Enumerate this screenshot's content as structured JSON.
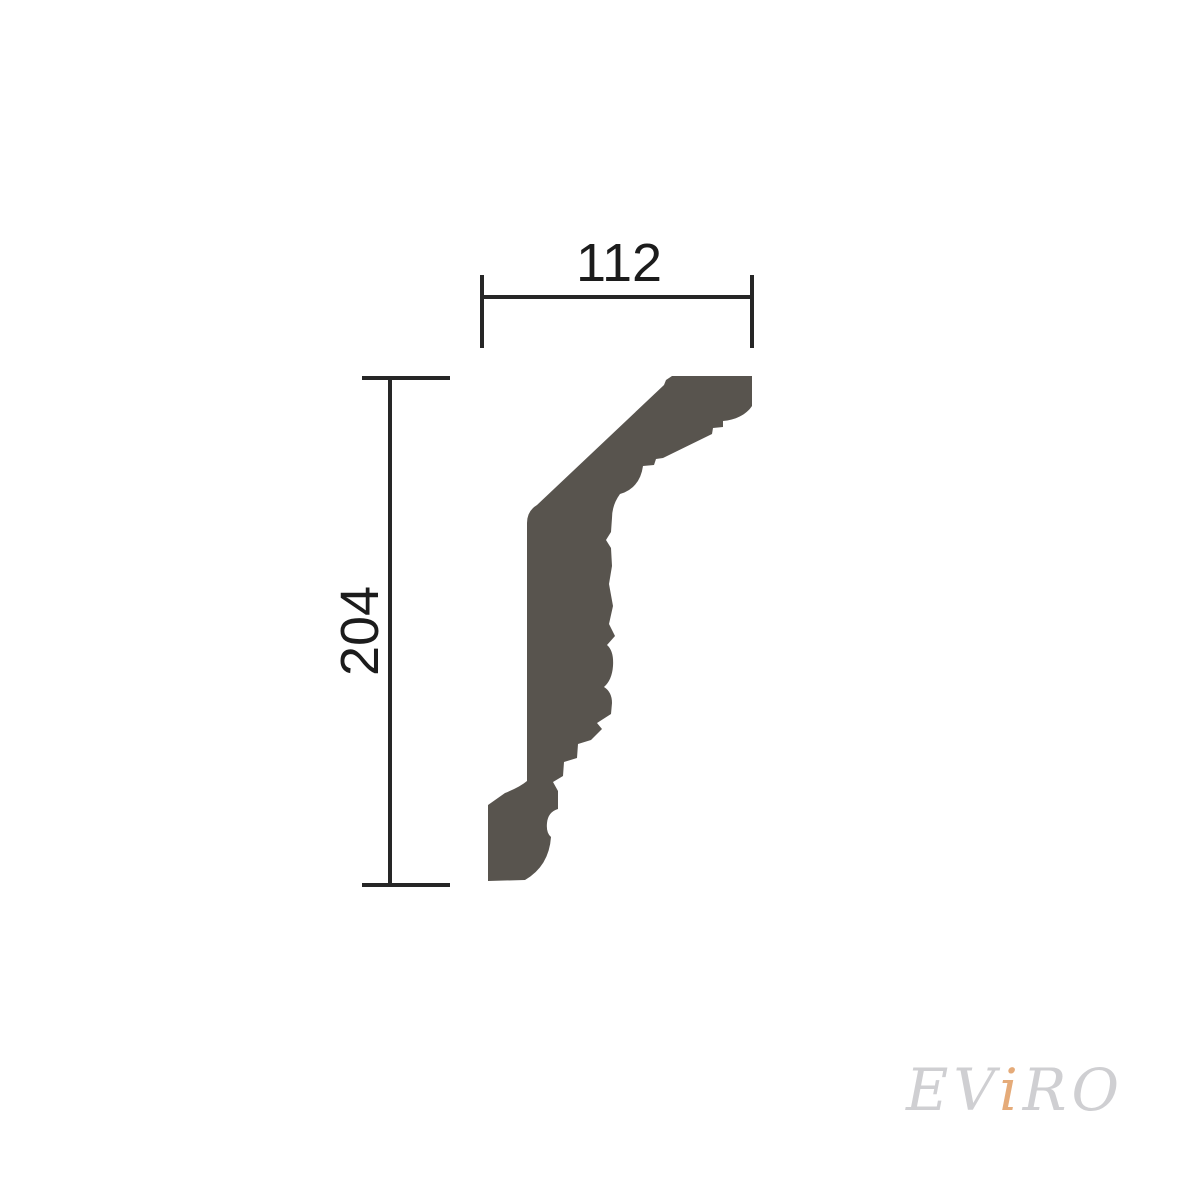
{
  "diagram": {
    "dimensions": {
      "width_label": "112",
      "height_label": "204"
    },
    "profile": {
      "fill": "#58544E",
      "path": "M 672 376 L 752 376 L 752 406 C 746 415 735 420 723 421 L 723 427 L 713 428 L 712 434 L 663 458 L 656 459 L 654 465 L 643 466 Q 640 488 620 494 Q 612 505 612 518 L 611 532 L 606 540 L 611 548 L 612 566 L 609 584 L 613 606 L 609 624 L 615 636 L 607 645 Q 614 651 613 666 Q 612 680 604 687 Q 612 692 612 703 L 611 714 L 597 723 L 602 729 L 591 740 L 578 744 L 577 758 L 564 762 L 563 776 L 553 782 L 558 791 L 558 809 Q 548 812 547 823 Q 546 833 551 837 Q 549 866 525 880 L 488 881 L 488 805 L 505 793 Q 520 787 527 781 L 527 523 Q 527 511 537 505 L 664 385 L 666 380 Z"
    },
    "lines": {
      "color": "#262626",
      "thickness": "4"
    }
  },
  "watermark": {
    "part1": "EV",
    "part2": "i",
    "part3": "RO",
    "gray_color": "#cfcfd2",
    "accent_color": "#e5ab79"
  }
}
